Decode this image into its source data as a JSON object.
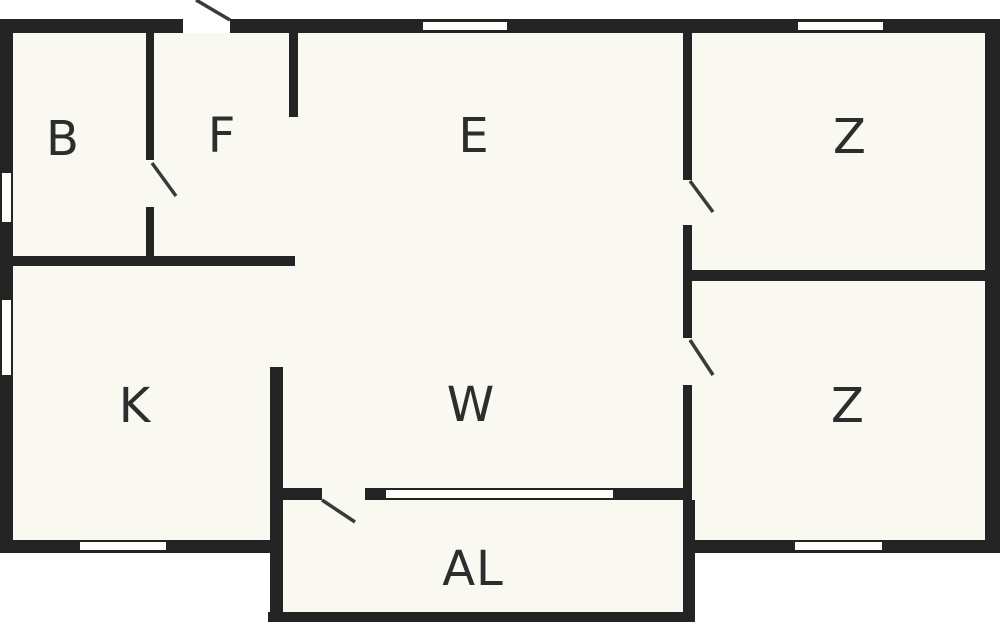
{
  "plan": {
    "type": "floor-plan",
    "width_px": 1000,
    "height_px": 622
  },
  "rooms": [
    {
      "label": "B"
    },
    {
      "label": "F"
    },
    {
      "label": "E"
    },
    {
      "label": "Z"
    },
    {
      "label": "K"
    },
    {
      "label": "W"
    },
    {
      "label": "Z"
    },
    {
      "label": "AL"
    }
  ],
  "colors": {
    "wall": "#242424",
    "floor": "#f9f8f1",
    "background": "#ffffff",
    "label": "#2d2d2d",
    "door_line": "#3a3a3a",
    "window_fill": "#fdfdfa"
  }
}
